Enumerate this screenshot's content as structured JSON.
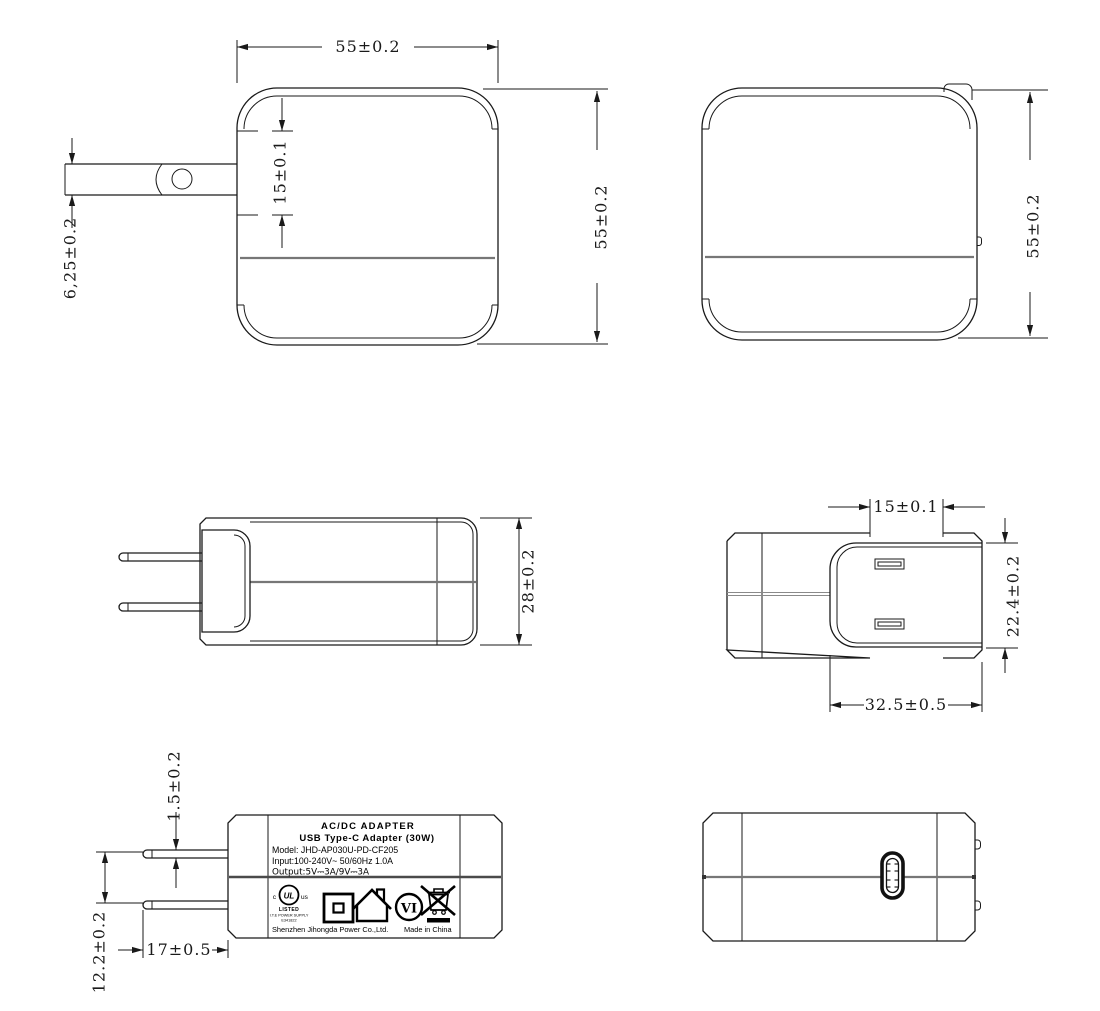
{
  "drawing": {
    "views": {
      "front": {
        "dims": {
          "width": "55±0.2",
          "height": "55±0.2",
          "slot_width": "15±0.1",
          "blade_width": "6,25±0.2"
        }
      },
      "rear": {
        "dims": {
          "height": "55±0.2"
        }
      },
      "side": {
        "dims": {
          "thickness": "28±0.2"
        }
      },
      "top": {
        "dims": {
          "slot_width": "15±0.1",
          "plug_depth": "22.4±0.2",
          "plug_width": "32.5±0.5"
        }
      },
      "label": {
        "dims": {
          "blade_thickness": "1.5±0.2",
          "blade_pitch": "12.2±0.2",
          "blade_length": "17±0.5"
        },
        "text": {
          "line1": "AC/DC  ADAPTER",
          "line2": "USB Type-C Adapter   (30W)",
          "line3": "Model: JHD-AP030U-PD-CF205",
          "line4": "Input:100-240V~  50/60Hz  1.0A",
          "line5": "Output:5V⎓3A/9V⎓3A",
          "ul_c": "c",
          "ul_logo": "UL",
          "ul_us": "us",
          "ul_listed": "LISTED",
          "ul_type": "I.T.E POWER SUPPLY",
          "ul_file": "E341822",
          "efficiency": "VI",
          "company": "Shenzhen Jihongda Power Co.,Ltd.",
          "origin": "Made in China"
        }
      }
    },
    "colors": {
      "line": "#1a1a1a",
      "seam": "#777777",
      "background": "#ffffff"
    }
  }
}
